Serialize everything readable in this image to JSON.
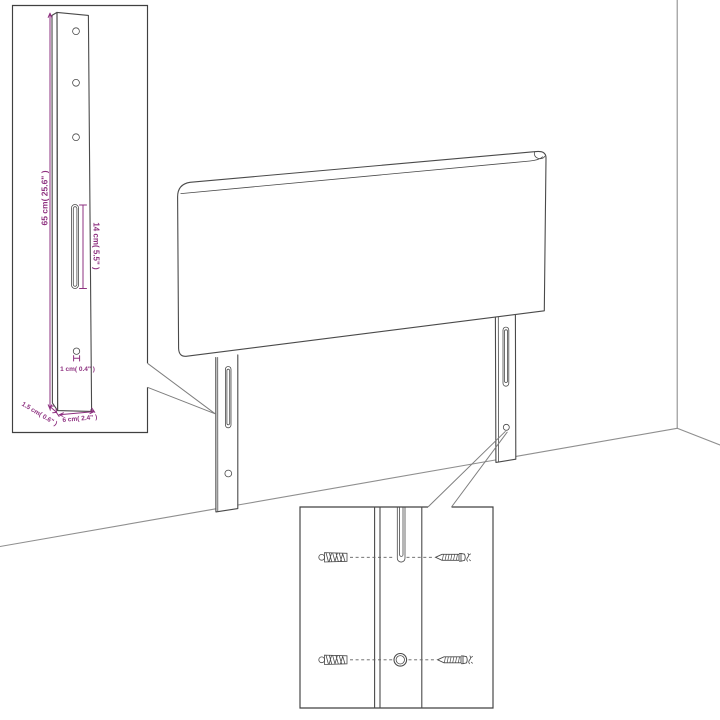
{
  "diagram": {
    "dimensions": {
      "height": "65 cm( 25.6\" )",
      "slot_length": "14 cm( 5.5\" )",
      "hole_diameter": "1 cm( 0.4\" )",
      "leg_thickness": "1.5 cm( 0.6\" )",
      "leg_width": "6 cm( 2.4\" )"
    },
    "colors": {
      "dimension_text": "#8e3180",
      "outline": "#4a4a4a",
      "wall_line": "#8f8f8f",
      "background": "#ffffff"
    }
  }
}
